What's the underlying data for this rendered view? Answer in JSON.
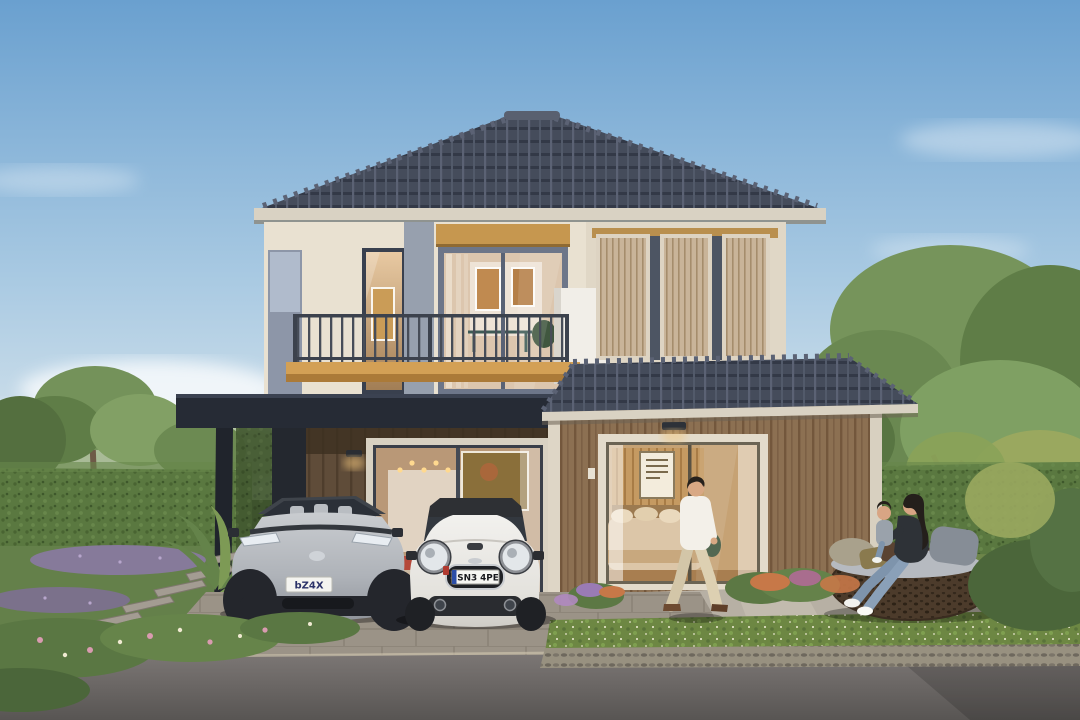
{
  "window": {
    "width": 1080,
    "height": 720
  },
  "scene": {
    "type": "architectural-exterior-rendering",
    "description": "Modern two-storey detached house at dusk with dark hip tile roofs, cream upper facade with balcony, timber louvre screens, brown batten lower walls, carport with two cars, and a family in the landscaped front yard",
    "time_of_day": "dusk, warm interior lights on",
    "weather": "clear blue sky with soft clouds"
  },
  "house": {
    "storeys": 2,
    "roof": "dark slate hip roof with ridge caps",
    "upper_facade": "cream panels, tall warm-lit windows, sliding glass door with oak header",
    "balcony": "dark metal railing on oak timber edge",
    "louvre_screens": "vertical tan timber slat panels on upper right wing",
    "lower_facade": "brown vertical batten siding",
    "bedroom_window": "full-height glazing showing warm-lit bedroom",
    "carport": "charcoal flat canopy with living-room glazing behind cars"
  },
  "vehicles": {
    "suv": {
      "type": "grey electric SUV",
      "plate": "bZ4X"
    },
    "mini": {
      "type": "white MINI hatchback with black roof",
      "plate": "SN3 4PE"
    }
  },
  "people": {
    "man": "man in white shirt and beige trousers walking to the right",
    "woman_and_child": "woman with long dark hair holding a toddler on a round rattan daybed"
  },
  "garden": {
    "left": "clipped hedge wall, trees, palm fronds, lavender drifts, stepping-stone path",
    "right": "hedge wall, large trees, round rattan daybed on lawn pad, flower bed with orange and purple blooms",
    "front": "low flowering hedge strip, cobble curb band, asphalt road"
  },
  "colors": {
    "sky_top": "#6aa0cf",
    "sky_horizon": "#dfe9ee",
    "roof_tile": "#454c5b",
    "fascia_cream": "#d9d2c3",
    "wall_cream": "#e9e1d1",
    "wall_brown": "#8c7052",
    "oak_wood": "#cf9c52",
    "charcoal": "#262b35",
    "hedge_green": "#5a7840",
    "lawn_green": "#6d8549",
    "driveway_gray": "#a29b91",
    "road_asphalt": "#6b6765",
    "suv_silver": "#b4b8bd",
    "mini_white": "#e9e7e2",
    "warm_light": "#e8c9a2"
  }
}
